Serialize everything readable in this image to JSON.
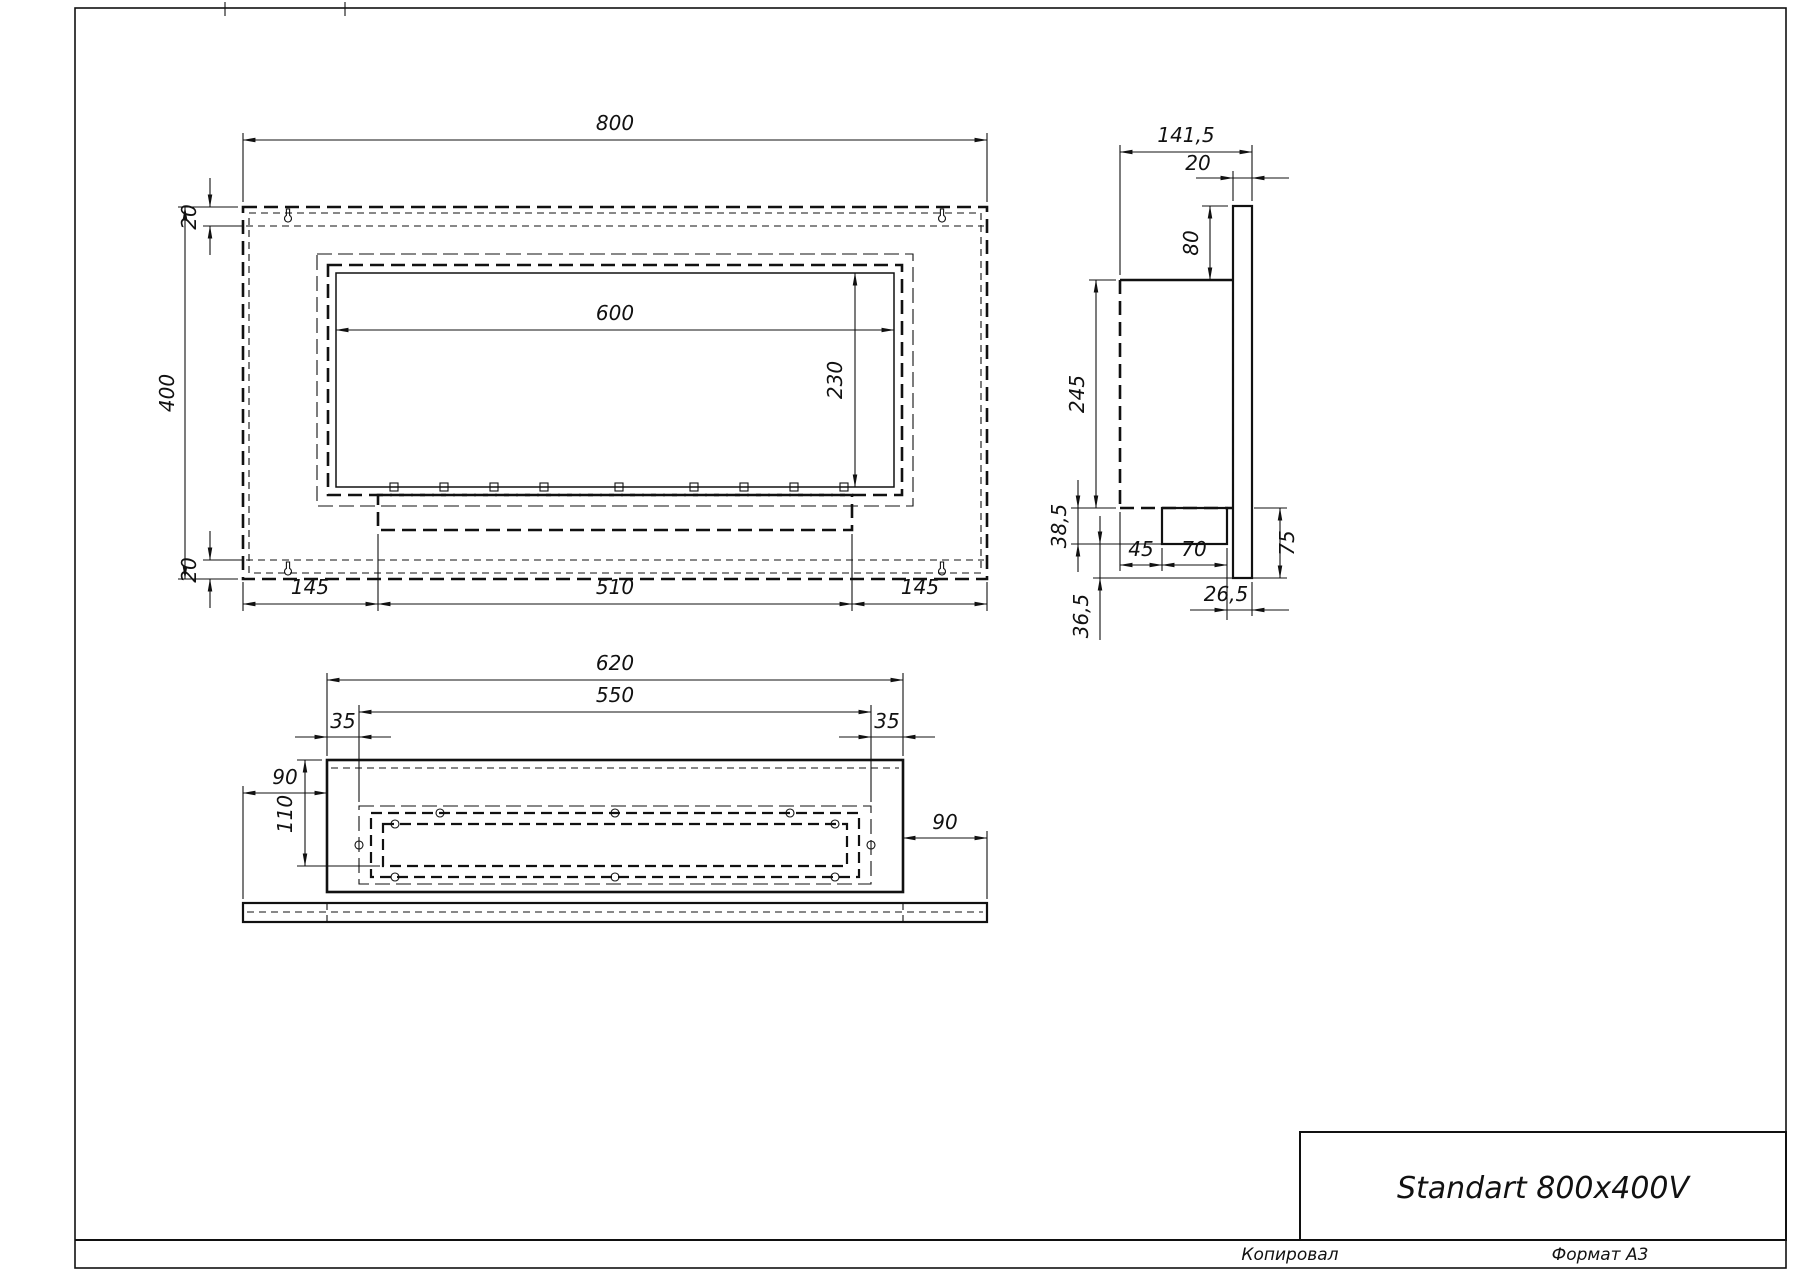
{
  "title_block": {
    "title": "Standart 800x400V"
  },
  "footer": {
    "copied": "Копировал",
    "format": "Формат А3"
  },
  "front_view": {
    "dims": {
      "width": "800",
      "height": "400",
      "top_offset": "20",
      "bottom_offset": "20",
      "opening_width": "600",
      "opening_height": "230",
      "bottom_left": "145",
      "bottom_center": "510",
      "bottom_right": "145"
    }
  },
  "side_view": {
    "dims": {
      "depth": "141,5",
      "wall_thickness": "20",
      "back_top_ext": "80",
      "body_height": "245",
      "tray_height": "38,5",
      "below_tray": "36,5",
      "tray_offset": "45",
      "tray_width": "70",
      "back_bottom_ext": "75",
      "back_gap": "26,5"
    }
  },
  "bottom_view": {
    "dims": {
      "body_width": "620",
      "inner_width": "550",
      "inset_left": "35",
      "inset_right": "35",
      "flange_left": "90",
      "flange_right": "90",
      "depth": "110"
    }
  }
}
